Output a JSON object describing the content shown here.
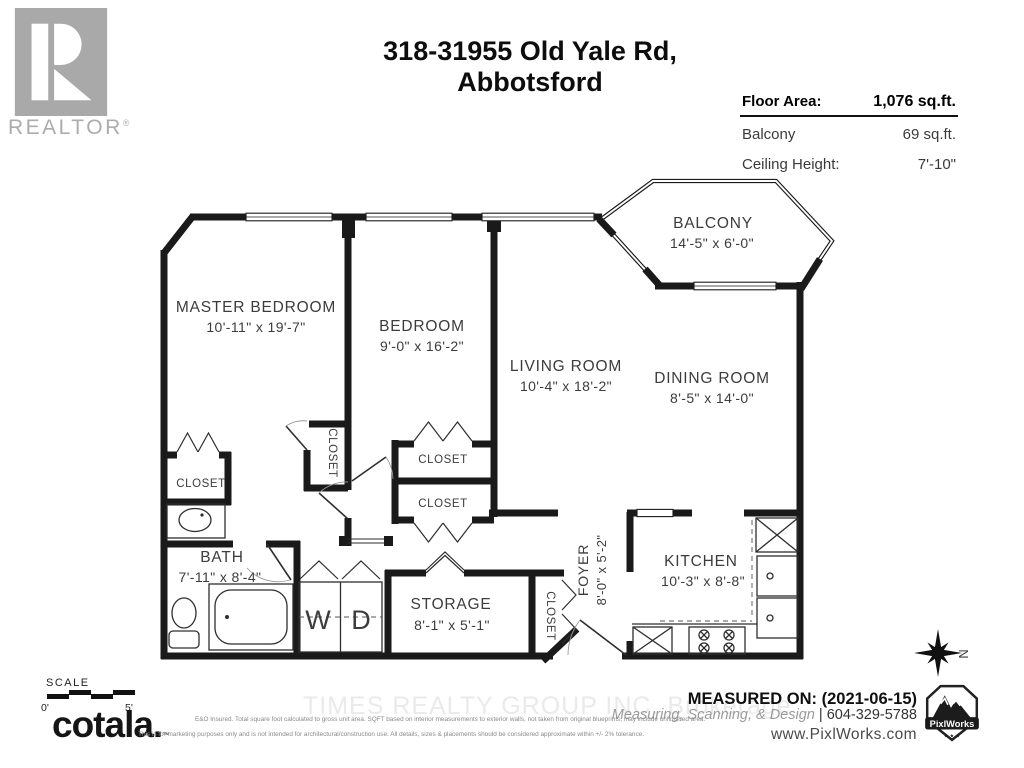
{
  "branding": {
    "realtor_word": "REALTOR",
    "registered": "®"
  },
  "title": {
    "line1": "318-31955 Old Yale Rd,",
    "line2": "Abbotsford"
  },
  "info_panel": {
    "rows": [
      {
        "label": "Floor Area:",
        "value": "1,076 sq.ft."
      },
      {
        "label": "Balcony",
        "value": "69 sq.ft."
      },
      {
        "label": "Ceiling Height:",
        "value": "7'-10\""
      }
    ]
  },
  "rooms": {
    "balcony": {
      "name": "BALCONY",
      "dims": "14'-5\" x 6'-0\""
    },
    "master_bedroom": {
      "name": "MASTER BEDROOM",
      "dims": "10'-11\" x 19'-7\""
    },
    "bedroom": {
      "name": "BEDROOM",
      "dims": "9'-0\" x 16'-2\""
    },
    "living_room": {
      "name": "LIVING ROOM",
      "dims": "10'-4\" x 18'-2\""
    },
    "dining_room": {
      "name": "DINING ROOM",
      "dims": "8'-5\" x 14'-0\""
    },
    "bath": {
      "name": "BATH",
      "dims": "7'-11\" x 8'-4\""
    },
    "storage": {
      "name": "STORAGE",
      "dims": "8'-1\" x 5'-1\""
    },
    "foyer": {
      "name": "FOYER",
      "dims": "8'-0\" x 5'-2\""
    },
    "kitchen": {
      "name": "KITCHEN",
      "dims": "10'-3\" x 8'-8\""
    }
  },
  "labels": {
    "closet": "CLOSET",
    "washer": "W",
    "dryer": "D",
    "north": "N"
  },
  "scale": {
    "label": "SCALE",
    "start": "0'",
    "end": "5'"
  },
  "footer": {
    "watermark": "TIMES REALTY GROUP INC.  Brokerage",
    "measured_on": "MEASURED ON: (2021-06-15)",
    "services": "Measuring, Scanning, & Design",
    "separator": " | ",
    "phone": "604-329-5788",
    "website": "www.PixlWorks.com",
    "brand": "cotala.",
    "brand_mark": "™",
    "pixlworks_label": "PixlWorks",
    "pixlworks_stars": "★ ★ ★",
    "disclaimer_line1": "E&O Insured.  Total square foot calculated to gross unit area. SQFT based on interior measurements to exterior walls, not taken from original blueprints, may include unfinished area.",
    "disclaimer_line2": "This is for marketing purposes only and is not intended for architectural/construction use.  All details, sizes & placements should be considered approximate within +/- 2%  tolerance."
  },
  "colors": {
    "wall": "#1a1a1a",
    "label": "#3c3c3c",
    "logo_gray": "#a9a9a9",
    "watermark": "#eaeaea"
  }
}
